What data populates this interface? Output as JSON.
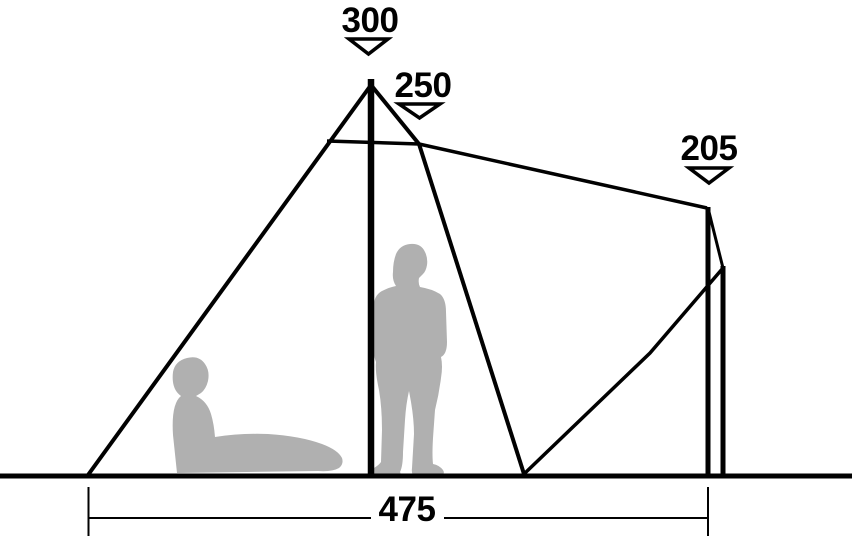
{
  "diagram": {
    "type": "tent-side-profile-dimension-diagram",
    "colors": {
      "background_color": "#ffffff",
      "line_color": "#010101",
      "silhouette_color": "#b0b0b0"
    },
    "labels": {
      "peak_height": "300",
      "canopy_height": "250",
      "rear_pole_height": "205",
      "floor_width": "475"
    },
    "dimensions": {
      "peak_height": 300,
      "canopy_height": 250,
      "rear_pole_height": 205,
      "floor_width": 475
    },
    "icons": [
      "down-arrow-icon under 300",
      "down-arrow-icon under 250",
      "down-arrow-icon under 205"
    ],
    "figures": [
      "sitting-person-silhouette",
      "standing-person-silhouette"
    ]
  }
}
